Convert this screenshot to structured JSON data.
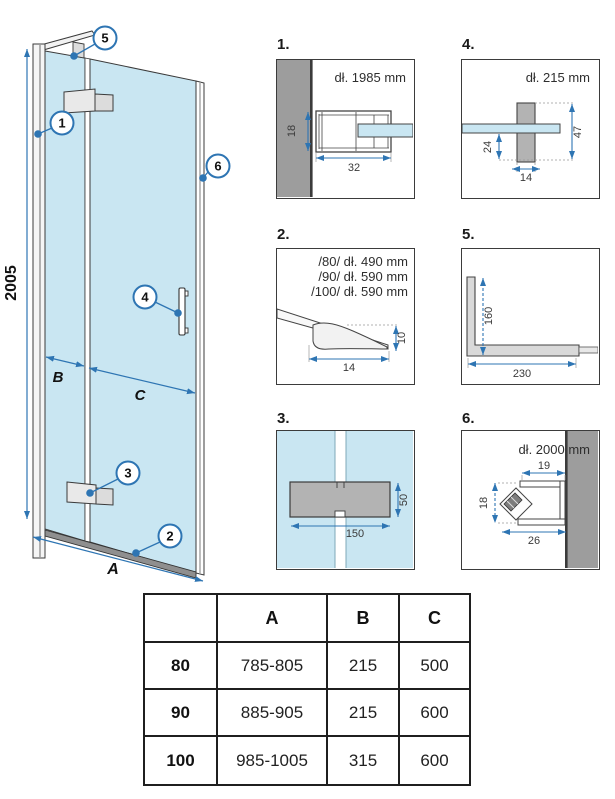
{
  "colors": {
    "glass": "#c9e6f2",
    "wall_gray": "#9d9d9d",
    "part_gray": "#b3b3b3",
    "hinge_light": "#e9e9e9",
    "bracket_gray": "#d9d9d9",
    "dim_blue": "#2e75b3",
    "line_dark": "#3b3b3b"
  },
  "main": {
    "dim_height": "2005",
    "dim_a": "A",
    "dim_b": "B",
    "dim_c": "C",
    "callouts": [
      "1",
      "2",
      "3",
      "4",
      "5",
      "6"
    ]
  },
  "details": {
    "d1": {
      "num": "1.",
      "length": "dł. 1985 mm",
      "dim_h": "18",
      "dim_w": "32"
    },
    "d2": {
      "num": "2.",
      "line80": "/80/ dł. 490 mm",
      "line90": "/90/ dł. 590 mm",
      "line100": "/100/ dł. 590 mm",
      "dim_h": "10",
      "dim_w": "14"
    },
    "d3": {
      "num": "3.",
      "dim_h": "50",
      "dim_w": "150"
    },
    "d4": {
      "num": "4.",
      "length": "dł. 215 mm",
      "dim_offset": "24",
      "dim_h": "47",
      "dim_w": "14"
    },
    "d5": {
      "num": "5.",
      "dim_h": "160",
      "dim_w": "230"
    },
    "d6": {
      "num": "6.",
      "length": "dł. 2000 mm",
      "dim_top": "19",
      "dim_h": "18",
      "dim_w": "26"
    }
  },
  "table": {
    "headers": [
      "",
      "A",
      "B",
      "C"
    ],
    "rows": [
      {
        "size": "80",
        "a": "785-805",
        "b": "215",
        "c": "500"
      },
      {
        "size": "90",
        "a": "885-905",
        "b": "215",
        "c": "600"
      },
      {
        "size": "100",
        "a": "985-1005",
        "b": "315",
        "c": "600"
      }
    ]
  }
}
